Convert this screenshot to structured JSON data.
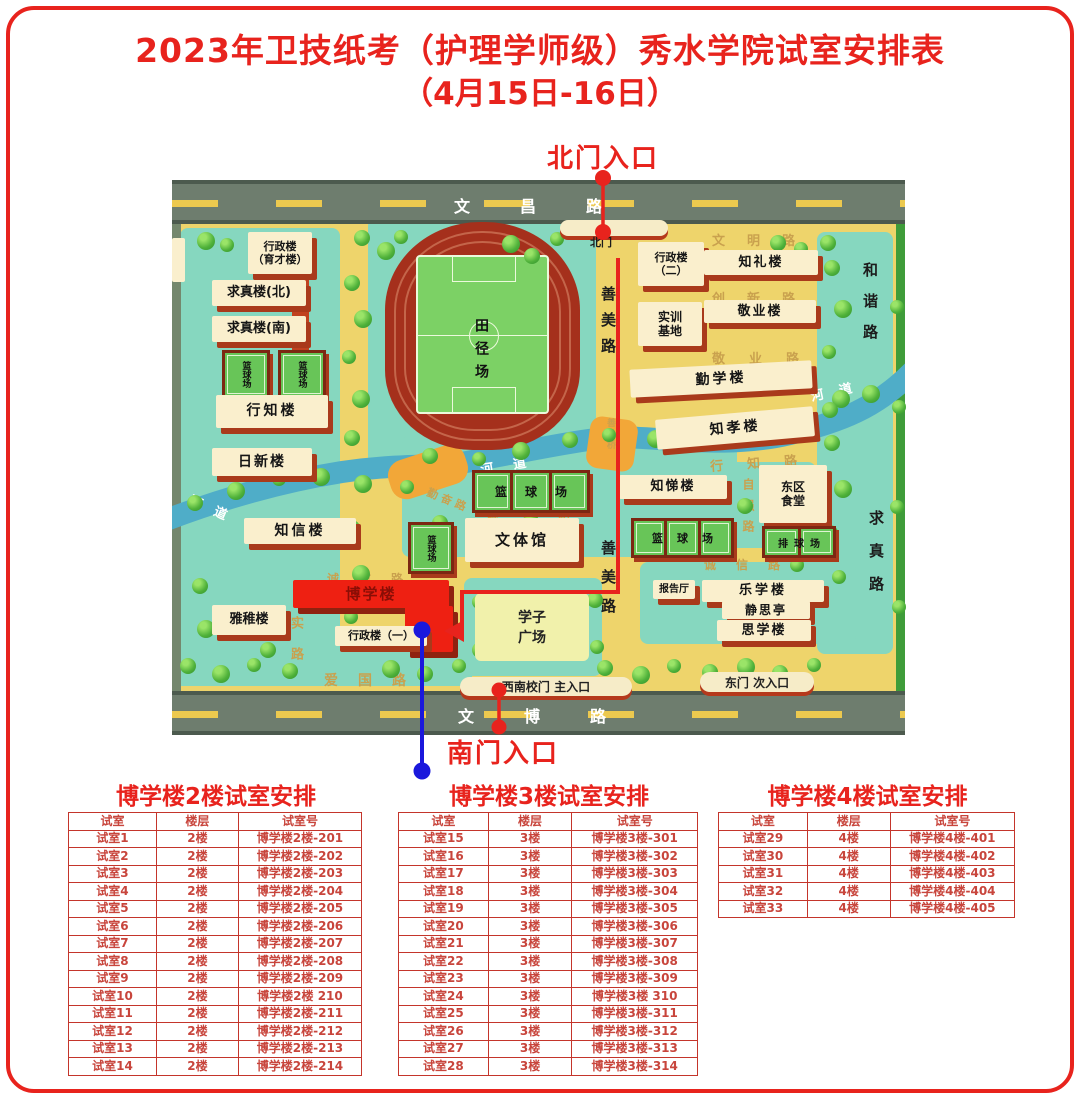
{
  "title": {
    "line1": "2023年卫技纸考（护理学师级）秀水学院试室安排表",
    "line2": "（4月15日-16日）"
  },
  "colors": {
    "accent_red": "#e8231d",
    "route_blue": "#1a18dc",
    "map_yellow": "#eed46b",
    "highlight_building": "#ee2012"
  },
  "map": {
    "entrances": {
      "north": "北门入口",
      "south": "南门入口"
    },
    "gates": {
      "north_gate": "北门",
      "southwest": "西南校门  主入口",
      "east": "东门  次入口"
    },
    "outer_roads": {
      "top": "文昌路",
      "bottom": "文博路"
    },
    "roads": {
      "wenming": "文明路",
      "chuangxin": "创新路",
      "jingye": "敬业路",
      "hexie": "和谐路",
      "qiuzhen": "求真路",
      "shanmei_upper": "善美路",
      "shanmei_lower": "善美路",
      "ziqiang": "自强路",
      "xingzhi": "行知路",
      "chengxin_east": "诚信路",
      "chengxin_center": "诚信路",
      "chengxin_west": "诚信路",
      "qinfen": "勤奋路",
      "aiguo": "爱国路",
      "shi_lu": "实路",
      "qiao": "桥",
      "shanmeiqiao": "善美桥",
      "hedao_west": "河道",
      "hedao_center": "河道",
      "hedao_east": "河道"
    },
    "buildings": {
      "yucai": "行政楼\n（育才楼）",
      "qiuzhen_north": "求真楼(北)",
      "qiuzhen_south": "求真楼(南)",
      "xingzhi": "行知楼",
      "rixin": "日新楼",
      "zhixin": "知信楼",
      "yazhi": "雅稚楼",
      "boxue": "博学楼",
      "xingzheng1": "行政楼（一）",
      "wentiguan": "文体馆",
      "xingzheng2": "行政楼\n（二）",
      "zhili": "知礼楼",
      "shixun": "实训\n基地",
      "jingye": "敬业楼",
      "qinxue": "勤学楼",
      "zhixiao": "知孝楼",
      "zhiti": "知悌楼",
      "dongqu": "东区\n食堂",
      "baogaoting": "报告厅",
      "lexue": "乐学楼",
      "jingsiting": "静思亭",
      "sixue": "思学楼"
    },
    "places": {
      "tianjing": "田径场",
      "xuezi": "学子\n广场",
      "basketball": "篮球场",
      "volleyball": "排球场"
    }
  },
  "tables": [
    {
      "title": "博学楼2楼试室安排",
      "headers": [
        "试室",
        "楼层",
        "试室号"
      ],
      "rows": [
        [
          "试室1",
          "2楼",
          "博学楼2楼-201"
        ],
        [
          "试室2",
          "2楼",
          "博学楼2楼-202"
        ],
        [
          "试室3",
          "2楼",
          "博学楼2楼-203"
        ],
        [
          "试室4",
          "2楼",
          "博学楼2楼-204"
        ],
        [
          "试室5",
          "2楼",
          "博学楼2楼-205"
        ],
        [
          "试室6",
          "2楼",
          "博学楼2楼-206"
        ],
        [
          "试室7",
          "2楼",
          "博学楼2楼-207"
        ],
        [
          "试室8",
          "2楼",
          "博学楼2楼-208"
        ],
        [
          "试室9",
          "2楼",
          "博学楼2楼-209"
        ],
        [
          "试室10",
          "2楼",
          "博学楼2楼 210"
        ],
        [
          "试室11",
          "2楼",
          "博学楼2楼-211"
        ],
        [
          "试室12",
          "2楼",
          "博学楼2楼-212"
        ],
        [
          "试室13",
          "2楼",
          "博学楼2楼-213"
        ],
        [
          "试室14",
          "2楼",
          "博学楼2楼-214"
        ]
      ]
    },
    {
      "title": "博学楼3楼试室安排",
      "headers": [
        "试室",
        "楼层",
        "试室号"
      ],
      "rows": [
        [
          "试室15",
          "3楼",
          "博学楼3楼-301"
        ],
        [
          "试室16",
          "3楼",
          "博学楼3楼-302"
        ],
        [
          "试室17",
          "3楼",
          "博学楼3楼-303"
        ],
        [
          "试室18",
          "3楼",
          "博学楼3楼-304"
        ],
        [
          "试室19",
          "3楼",
          "博学楼3楼-305"
        ],
        [
          "试室20",
          "3楼",
          "博学楼3楼-306"
        ],
        [
          "试室21",
          "3楼",
          "博学楼3楼-307"
        ],
        [
          "试室22",
          "3楼",
          "博学楼3楼-308"
        ],
        [
          "试室23",
          "3楼",
          "博学楼3楼-309"
        ],
        [
          "试室24",
          "3楼",
          "博学楼3楼 310"
        ],
        [
          "试室25",
          "3楼",
          "博学楼3楼-311"
        ],
        [
          "试室26",
          "3楼",
          "博学楼3楼-312"
        ],
        [
          "试室27",
          "3楼",
          "博学楼3楼-313"
        ],
        [
          "试室28",
          "3楼",
          "博学楼3楼-314"
        ]
      ]
    },
    {
      "title": "博学楼4楼试室安排",
      "headers": [
        "试室",
        "楼层",
        "试室号"
      ],
      "rows": [
        [
          "试室29",
          "4楼",
          "博学楼4楼-401"
        ],
        [
          "试室30",
          "4楼",
          "博学楼4楼-402"
        ],
        [
          "试室31",
          "4楼",
          "博学楼4楼-403"
        ],
        [
          "试室32",
          "4楼",
          "博学楼4楼-404"
        ],
        [
          "试室33",
          "4楼",
          "博学楼4楼-405"
        ]
      ]
    }
  ]
}
